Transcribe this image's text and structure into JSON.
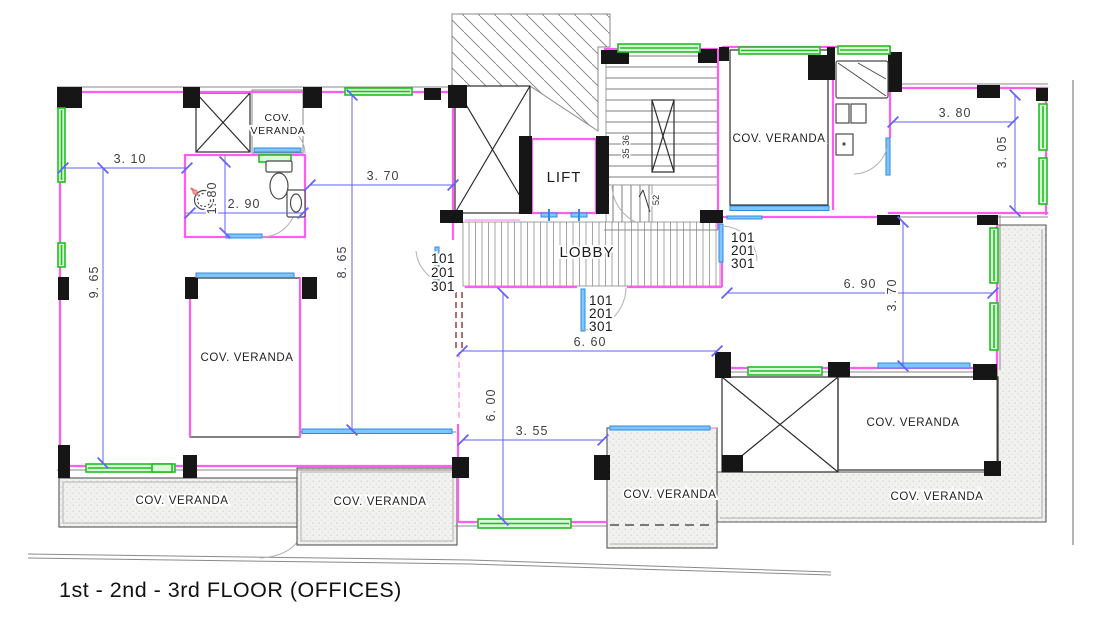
{
  "title": "1st - 2nd - 3rd FLOOR (OFFICES)",
  "rooms": {
    "lift": "LIFT",
    "lobby": "LOBBY",
    "cov_veranda": "COV. VERANDA",
    "cov_line1": "COV.",
    "cov_line2": "VERANDA"
  },
  "door_units": {
    "u1": "101",
    "u2": "201",
    "u3": "301"
  },
  "stairs": {
    "risers": "35 36",
    "count": "52"
  },
  "dimensions": {
    "left_top_width": "3. 10",
    "left_mid_width": "3. 70",
    "left_height": "9. 65",
    "mid_height": "8. 65",
    "wc_depth": "1. 80",
    "wc_width": "2. 90",
    "right_top_width": "3. 80",
    "right_top_height": "3. 05",
    "right_room_width": "6. 90",
    "right_room_height": "3. 70",
    "bottom_room_width": "6. 60",
    "bottom_room_height": "6. 00",
    "bottom_opening_width": "3. 55"
  },
  "colors": {
    "wall": "#ff5df2",
    "window": "#1fbf1f",
    "door_sill": "#3d9bff",
    "dimension": "#6262ff",
    "column": "#161616",
    "veranda_grid": "#5c9478",
    "hidden_red": "#8b1f1f"
  }
}
